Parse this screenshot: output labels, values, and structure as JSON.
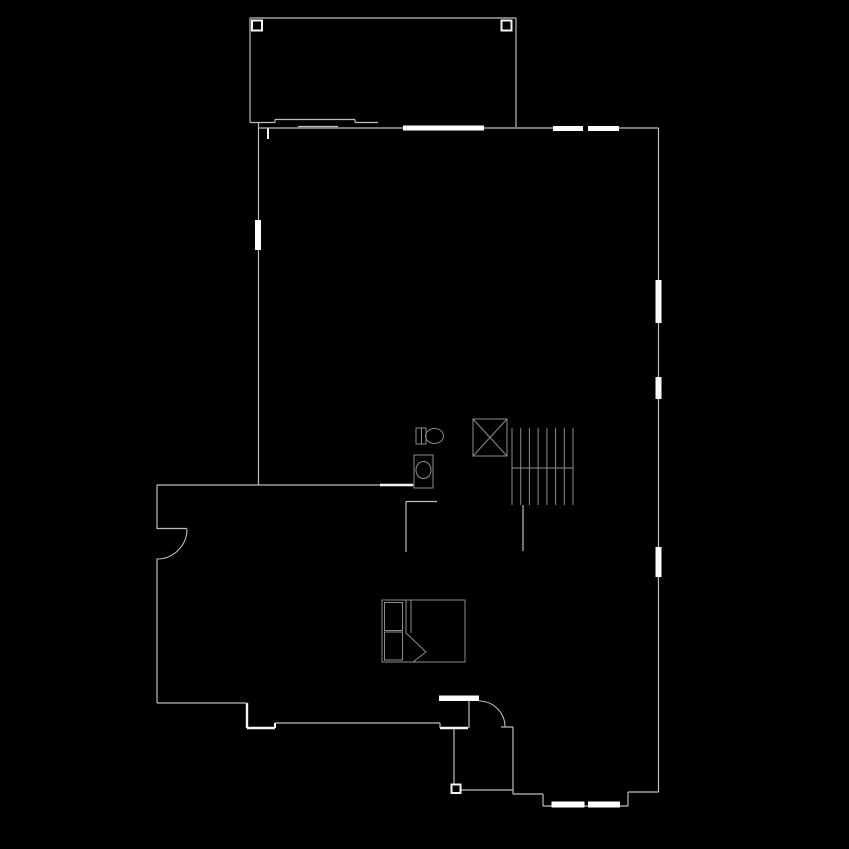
{
  "canvas": {
    "width": 849,
    "height": 849,
    "background": "#000000"
  },
  "colors": {
    "wall": "#bdbdbd",
    "bright": "#f5f5f5",
    "fixture": "#8c8c8c",
    "window": "#ffffff",
    "divider": "#8c8c8c"
  },
  "plan": {
    "lines": [
      {
        "n": "deck-top-wall",
        "x1": 250,
        "y1": 18,
        "x2": 516,
        "y2": 18
      },
      {
        "n": "deck-left-wall",
        "x1": 250,
        "y1": 18,
        "x2": 250,
        "y2": 122.5
      },
      {
        "n": "deck-right-wall",
        "x1": 516,
        "y1": 18,
        "x2": 516,
        "y2": 127
      },
      {
        "n": "deck-bottom-edge-left",
        "x1": 250,
        "y1": 122.5,
        "x2": 275,
        "y2": 122.5
      },
      {
        "n": "slider-threshold-top",
        "x1": 275,
        "y1": 119.5,
        "x2": 355,
        "y2": 119.5
      },
      {
        "n": "slider-threshold-jog-l",
        "x1": 275,
        "y1": 119.5,
        "x2": 275,
        "y2": 122.5
      },
      {
        "n": "slider-threshold-jog-r",
        "x1": 355,
        "y1": 119.5,
        "x2": 355,
        "y2": 122.5
      },
      {
        "n": "deck-bottom-edge-right",
        "x1": 355,
        "y1": 122.5,
        "x2": 378,
        "y2": 122.5
      },
      {
        "n": "slider-panel-line",
        "x1": 298,
        "y1": 126.5,
        "x2": 338,
        "y2": 126.5
      },
      {
        "n": "interior-wall-stub",
        "x1": 268,
        "y1": 128,
        "x2": 268,
        "y2": 139,
        "c": "bright",
        "w": 2
      },
      {
        "n": "top-wall-left",
        "x1": 258,
        "y1": 128,
        "x2": 403,
        "y2": 128
      },
      {
        "n": "top-wall-mid",
        "x1": 484,
        "y1": 128,
        "x2": 553,
        "y2": 128
      },
      {
        "n": "top-wall-right",
        "x1": 618,
        "y1": 128,
        "x2": 658.5,
        "y2": 128
      },
      {
        "n": "right-wall-seg-1",
        "x1": 658.5,
        "y1": 128,
        "x2": 658.5,
        "y2": 280
      },
      {
        "n": "right-wall-seg-2",
        "x1": 658.5,
        "y1": 323,
        "x2": 658.5,
        "y2": 377
      },
      {
        "n": "right-wall-seg-3",
        "x1": 658.5,
        "y1": 399,
        "x2": 658.5,
        "y2": 547
      },
      {
        "n": "right-wall-seg-4",
        "x1": 658.5,
        "y1": 577,
        "x2": 658.5,
        "y2": 792
      },
      {
        "n": "rear-step-top",
        "x1": 658.5,
        "y1": 792,
        "x2": 628,
        "y2": 792
      },
      {
        "n": "rear-step-vert",
        "x1": 628,
        "y1": 792,
        "x2": 628,
        "y2": 806
      },
      {
        "n": "bay-bottom-wall",
        "x1": 628,
        "y1": 806,
        "x2": 543,
        "y2": 806
      },
      {
        "n": "bay-left-vert",
        "x1": 543,
        "y1": 806,
        "x2": 543,
        "y2": 794
      },
      {
        "n": "bay-left-horiz",
        "x1": 543,
        "y1": 794,
        "x2": 513,
        "y2": 794
      },
      {
        "n": "entry-right-wall",
        "x1": 513,
        "y1": 794,
        "x2": 513,
        "y2": 727
      },
      {
        "n": "entry-jamb-right",
        "x1": 513,
        "y1": 727,
        "x2": 501,
        "y2": 727
      },
      {
        "n": "entry-wall-left",
        "x1": 468,
        "y1": 728,
        "x2": 440,
        "y2": 728,
        "c": "bright",
        "w": 2.4
      },
      {
        "n": "entry-step-vert",
        "x1": 440,
        "y1": 728,
        "x2": 440,
        "y2": 723
      },
      {
        "n": "front-wall",
        "x1": 440,
        "y1": 723,
        "x2": 275,
        "y2": 723
      },
      {
        "n": "front-step-vert-1",
        "x1": 275,
        "y1": 723,
        "x2": 275,
        "y2": 728,
        "c": "bright",
        "w": 2
      },
      {
        "n": "front-step-horiz",
        "x1": 275,
        "y1": 728,
        "x2": 247,
        "y2": 728,
        "c": "bright",
        "w": 2.4
      },
      {
        "n": "front-step-vert-2",
        "x1": 247,
        "y1": 728,
        "x2": 247,
        "y2": 703,
        "c": "bright",
        "w": 2.4
      },
      {
        "n": "front-wall-left",
        "x1": 247,
        "y1": 703,
        "x2": 157,
        "y2": 703
      },
      {
        "n": "entry-door-hinge-line",
        "x1": 469,
        "y1": 701,
        "x2": 469,
        "y2": 728
      },
      {
        "n": "left-wall-lower",
        "x1": 157,
        "y1": 703,
        "x2": 157,
        "y2": 558.5
      },
      {
        "n": "left-wall-upper",
        "x1": 157,
        "y1": 529,
        "x2": 157,
        "y2": 485
      },
      {
        "n": "left-door-leaf",
        "x1": 157,
        "y1": 528.5,
        "x2": 187,
        "y2": 528.5
      },
      {
        "n": "bedroom-top-wall",
        "x1": 157,
        "y1": 485,
        "x2": 414,
        "y2": 485
      },
      {
        "n": "bathroom-pocket-door",
        "x1": 380,
        "y1": 485,
        "x2": 413,
        "y2": 485,
        "c": "bright",
        "w": 2.4
      },
      {
        "n": "upper-left-wall",
        "x1": 258.5,
        "y1": 123,
        "x2": 258.5,
        "y2": 485
      },
      {
        "n": "closet-wall-horiz",
        "x1": 406,
        "y1": 501.5,
        "x2": 437,
        "y2": 501.5
      },
      {
        "n": "closet-wall-vert",
        "x1": 406,
        "y1": 501.5,
        "x2": 406,
        "y2": 552
      },
      {
        "n": "stair-side-wall",
        "x1": 523,
        "y1": 505,
        "x2": 523,
        "y2": 551
      },
      {
        "n": "porch-rail-vert",
        "x1": 454,
        "y1": 729,
        "x2": 454,
        "y2": 785
      },
      {
        "n": "porch-rail-horiz",
        "x1": 460,
        "y1": 790,
        "x2": 513,
        "y2": 790
      },
      {
        "n": "stair-tread-1",
        "x1": 512,
        "y1": 428,
        "x2": 512,
        "y2": 505,
        "c": "fixture",
        "w": 1
      },
      {
        "n": "stair-tread-2",
        "x1": 520.7,
        "y1": 428,
        "x2": 520.7,
        "y2": 505,
        "c": "fixture",
        "w": 1
      },
      {
        "n": "stair-tread-3",
        "x1": 529.4,
        "y1": 428,
        "x2": 529.4,
        "y2": 505,
        "c": "fixture",
        "w": 1
      },
      {
        "n": "stair-tread-4",
        "x1": 538.1,
        "y1": 428,
        "x2": 538.1,
        "y2": 505,
        "c": "fixture",
        "w": 1
      },
      {
        "n": "stair-tread-5",
        "x1": 546.9,
        "y1": 428,
        "x2": 546.9,
        "y2": 505,
        "c": "fixture",
        "w": 1
      },
      {
        "n": "stair-tread-6",
        "x1": 555.6,
        "y1": 428,
        "x2": 555.6,
        "y2": 505,
        "c": "fixture",
        "w": 1
      },
      {
        "n": "stair-tread-7",
        "x1": 564.3,
        "y1": 428,
        "x2": 564.3,
        "y2": 505,
        "c": "fixture",
        "w": 1
      },
      {
        "n": "stair-tread-8",
        "x1": 573,
        "y1": 428,
        "x2": 573,
        "y2": 505,
        "c": "fixture",
        "w": 1
      },
      {
        "n": "stair-break-line",
        "x1": 512,
        "y1": 468,
        "x2": 573,
        "y2": 468,
        "c": "fixture",
        "w": 1
      },
      {
        "n": "bed-blanket-line-1",
        "x1": 406,
        "y1": 600,
        "x2": 406,
        "y2": 633,
        "c": "fixture",
        "w": 1
      },
      {
        "n": "bed-blanket-line-2",
        "x1": 411,
        "y1": 600,
        "x2": 411,
        "y2": 633,
        "c": "fixture",
        "w": 1
      },
      {
        "n": "toilet-tank-divider",
        "x1": 421.5,
        "y1": 428,
        "x2": 421.5,
        "y2": 444,
        "c": "fixture",
        "w": 1
      },
      {
        "n": "window-divider-1",
        "x1": 423,
        "y1": 125.5,
        "x2": 423,
        "y2": 130.5,
        "c": "divider",
        "w": 1
      },
      {
        "n": "window-divider-2",
        "x1": 463,
        "y1": 125.5,
        "x2": 463,
        "y2": 130.5,
        "c": "divider",
        "w": 1
      },
      {
        "n": "shower-diagonal-1",
        "x1": 473,
        "y1": 419,
        "x2": 507,
        "y2": 456,
        "c": "fixture",
        "w": 1
      },
      {
        "n": "shower-diagonal-2",
        "x1": 507,
        "y1": 419,
        "x2": 473,
        "y2": 456,
        "c": "fixture",
        "w": 1
      }
    ],
    "windows": [
      {
        "n": "window-top-large",
        "x": 403,
        "y": 125.5,
        "w": 81,
        "h": 5
      },
      {
        "n": "window-top-right-1",
        "x": 553,
        "y": 126,
        "w": 30,
        "h": 5
      },
      {
        "n": "window-top-right-2",
        "x": 588,
        "y": 126,
        "w": 31,
        "h": 5
      },
      {
        "n": "window-right-1",
        "x": 655.5,
        "y": 280,
        "w": 6,
        "h": 43
      },
      {
        "n": "window-right-2",
        "x": 655.5,
        "y": 377,
        "w": 6,
        "h": 22
      },
      {
        "n": "window-right-3",
        "x": 655.5,
        "y": 547,
        "w": 6,
        "h": 30
      },
      {
        "n": "window-left-1",
        "x": 255,
        "y": 220,
        "w": 6,
        "h": 30
      },
      {
        "n": "window-bay-1",
        "x": 551.5,
        "y": 801.5,
        "w": 33,
        "h": 6
      },
      {
        "n": "window-bay-2",
        "x": 588,
        "y": 801.5,
        "w": 32,
        "h": 6
      },
      {
        "n": "entry-door-slab",
        "x": 439,
        "y": 695.5,
        "w": 40,
        "h": 5.5
      }
    ],
    "rects": [
      {
        "n": "deck-post-left",
        "x": 252,
        "y": 20.5,
        "w": 10,
        "h": 10,
        "c": "bright",
        "sw": 2
      },
      {
        "n": "deck-post-right",
        "x": 501.5,
        "y": 20.5,
        "w": 10,
        "h": 10,
        "c": "bright",
        "sw": 2
      },
      {
        "n": "porch-post",
        "x": 451.5,
        "y": 784.5,
        "w": 9,
        "h": 8.5,
        "c": "bright",
        "sw": 2
      },
      {
        "n": "shower-stall",
        "x": 473,
        "y": 419,
        "w": 34,
        "h": 37,
        "c": "fixture",
        "sw": 1
      },
      {
        "n": "toilet-tank",
        "x": 416,
        "y": 428,
        "w": 10,
        "h": 16,
        "c": "fixture",
        "sw": 1
      },
      {
        "n": "vanity-counter",
        "x": 414,
        "y": 455,
        "w": 19,
        "h": 33,
        "c": "fixture",
        "sw": 1
      },
      {
        "n": "bed-frame",
        "x": 382,
        "y": 600,
        "w": 83,
        "h": 62,
        "c": "fixture",
        "sw": 1
      },
      {
        "n": "bed-pillow-1",
        "x": 384.5,
        "y": 602.5,
        "w": 18,
        "h": 28,
        "c": "fixture",
        "sw": 1
      },
      {
        "n": "bed-pillow-2",
        "x": 384.5,
        "y": 632,
        "w": 18,
        "h": 28,
        "c": "fixture",
        "sw": 1
      }
    ],
    "ellipses": [
      {
        "n": "toilet-bowl",
        "cx": 434.5,
        "cy": 436,
        "rx": 9,
        "ry": 7.5,
        "c": "fixture"
      },
      {
        "n": "sink-basin",
        "cx": 423.5,
        "cy": 470,
        "rx": 7.5,
        "ry": 8.5,
        "c": "fixture"
      }
    ],
    "paths": [
      {
        "n": "left-door-swing-arc",
        "d": "M 187 529 A 30 30 0 0 1 157 559",
        "c": "wall",
        "w": 1.1
      },
      {
        "n": "entry-door-swing-arc",
        "d": "M 479 701 A 26 26 0 0 1 505 727",
        "c": "wall",
        "w": 1.1
      },
      {
        "n": "bed-fold-corner",
        "d": "M 406 633 L 426 652 L 413 662",
        "c": "fixture",
        "w": 1
      }
    ]
  }
}
